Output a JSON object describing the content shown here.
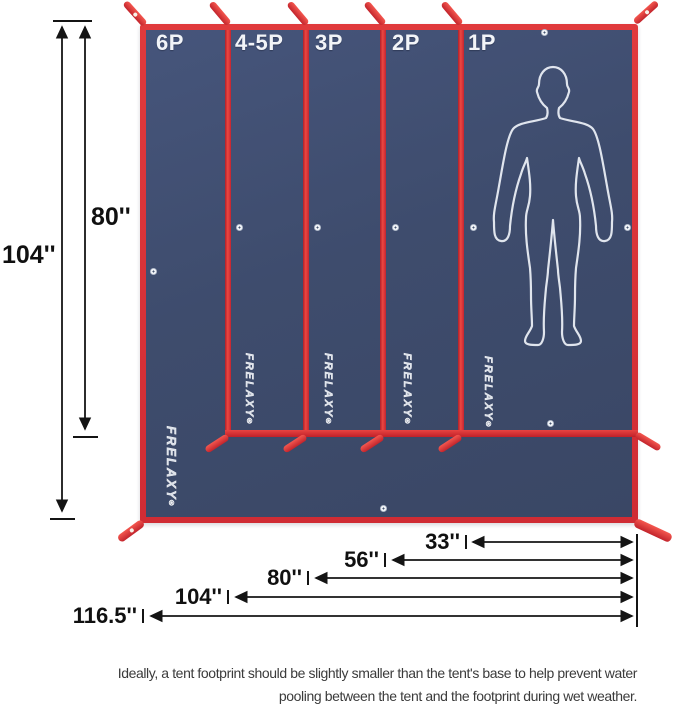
{
  "figure": {
    "type": "tent-footprint-size-diagram",
    "brand_mark": "FRELAXY",
    "registered": "®",
    "panels": [
      {
        "label": "6P"
      },
      {
        "label": "4-5P"
      },
      {
        "label": "3P"
      },
      {
        "label": "2P"
      },
      {
        "label": "1P"
      }
    ]
  },
  "dimensions": {
    "height_full": "104''",
    "height_inner": "80''",
    "widths": [
      {
        "label": "33''"
      },
      {
        "label": "56''"
      },
      {
        "label": "80''"
      },
      {
        "label": "104''"
      },
      {
        "label": "116.5''"
      }
    ]
  },
  "caption": {
    "line1": "Ideally, a tent footprint should be slightly smaller than the tent's base to help prevent water",
    "line2": "pooling between the tent and the footprint during wet weather."
  },
  "colors": {
    "fabric_navy": "#3e4c6d",
    "edge_red": "#d63034",
    "dimension_text": "#141414"
  }
}
